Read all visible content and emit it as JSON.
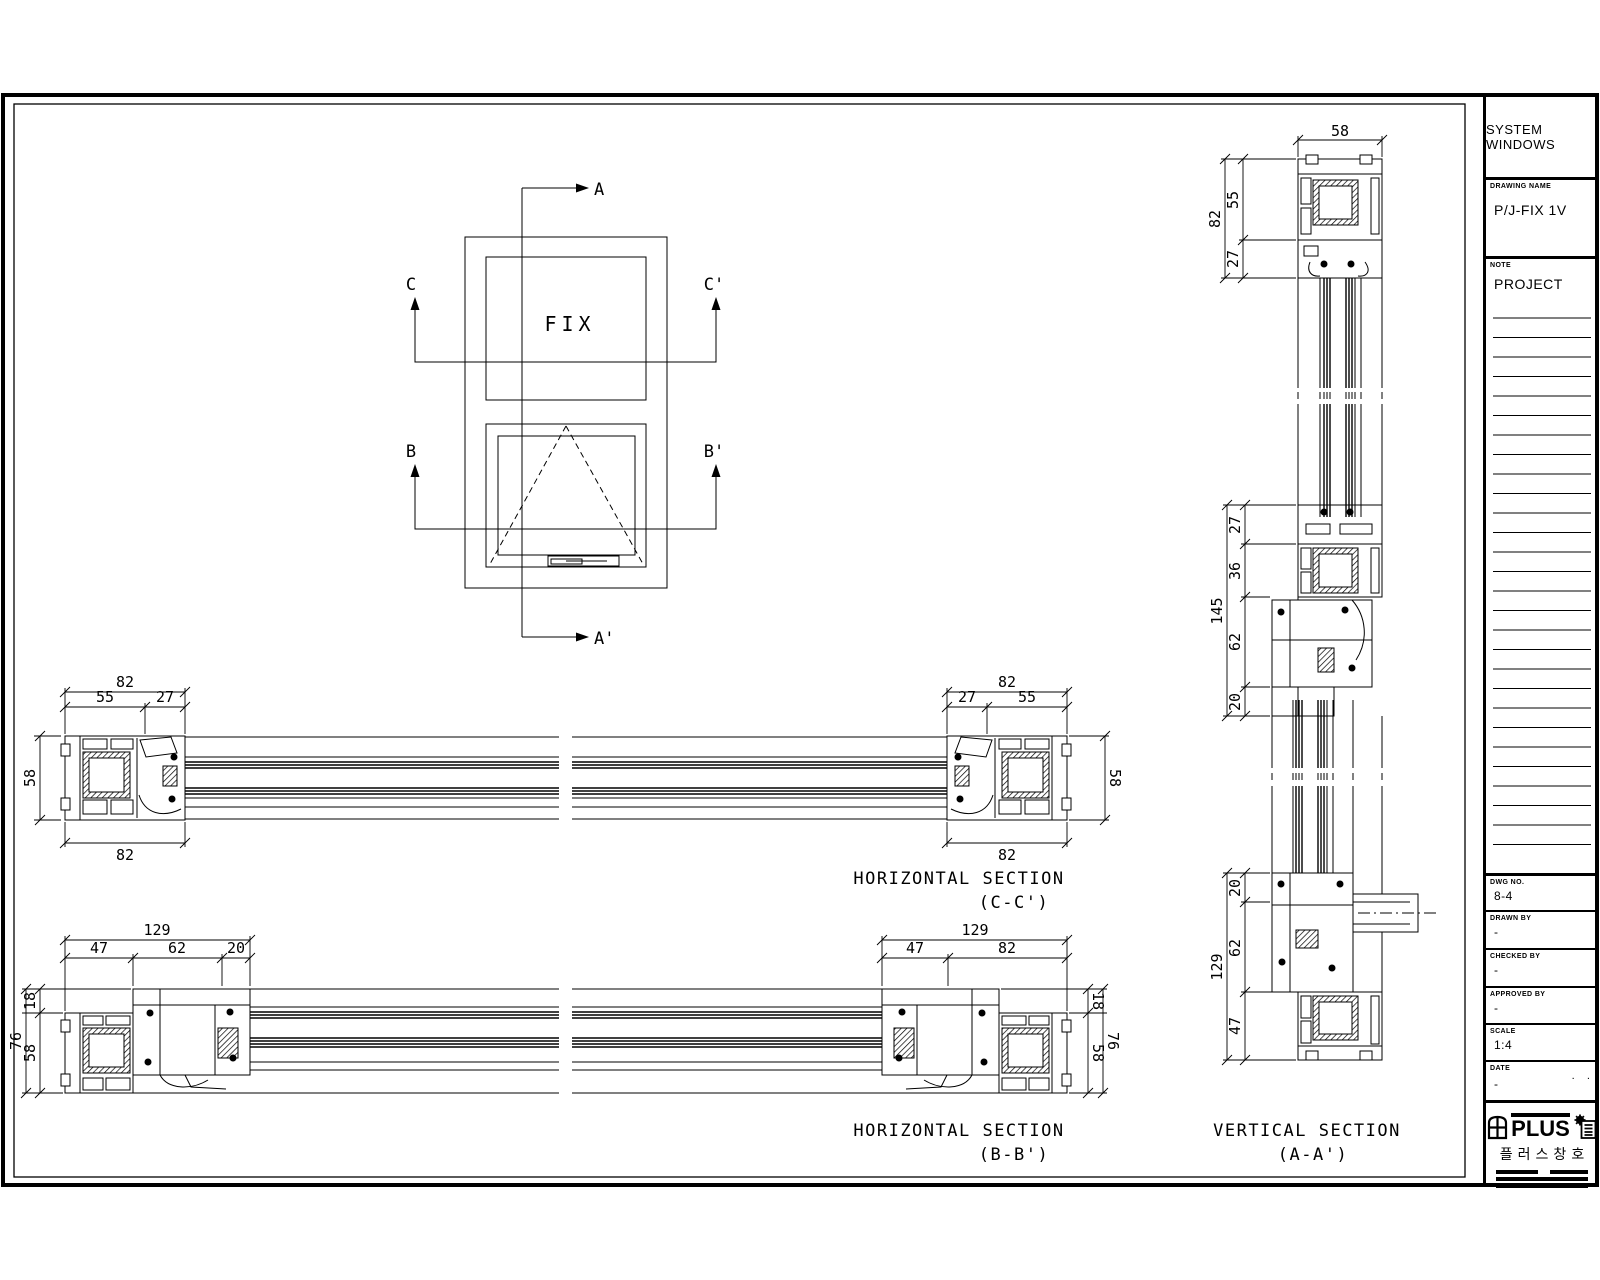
{
  "elevation": {
    "panel_label": "FIX",
    "markers": {
      "a": "A",
      "a_prime": "A'",
      "b": "B",
      "b_prime": "B'",
      "c": "C",
      "c_prime": "C'"
    }
  },
  "section_titles": {
    "cc": {
      "title": "HORIZONTAL SECTION",
      "sub": "(C-C')"
    },
    "bb": {
      "title": "HORIZONTAL SECTION",
      "sub": "(B-B')"
    },
    "aa": {
      "title": "VERTICAL SECTION",
      "sub": "(A-A')"
    }
  },
  "dims": {
    "cc_left": {
      "total": "82",
      "a": "55",
      "b": "27",
      "height": "58",
      "bottom": "82"
    },
    "cc_right": {
      "total": "82",
      "a": "27",
      "b": "55",
      "height": "58",
      "bottom": "82"
    },
    "bb_left": {
      "total": "129",
      "a": "47",
      "b": "62",
      "c": "20",
      "t18": "18",
      "t58": "58",
      "t76": "76"
    },
    "bb_right": {
      "total": "129",
      "a": "47",
      "b": "82",
      "t18": "18",
      "t58": "58",
      "t76": "76"
    },
    "aa": {
      "width": "58",
      "top_total": "82",
      "top_a": "55",
      "top_b": "27",
      "mid_total": "145",
      "mid_a": "27",
      "mid_b": "36",
      "mid_c": "62",
      "mid_d": "20",
      "bot_total": "129",
      "bot_a": "20",
      "bot_b": "62",
      "bot_c": "47"
    }
  },
  "title_block": {
    "system_title": "SYSTEM WINDOWS",
    "drawing_name_label": "DRAWING NAME",
    "drawing_name": "P/J-FIX 1V",
    "note_label": "NOTE",
    "note_value": "PROJECT",
    "dwg_no_label": "DWG NO.",
    "dwg_no": "8-4",
    "drawn_by_label": "DRAWN BY",
    "drawn_by": "-",
    "checked_by_label": "CHECKED BY",
    "checked_by": "-",
    "approved_by_label": "APPROVED BY",
    "approved_by": "-",
    "scale_label": "SCALE",
    "scale": "1:4",
    "date_label": "DATE",
    "date": "-",
    "date_dots": ".    .",
    "logo_text": "PLUS",
    "logo_sub": "플러스창호"
  }
}
